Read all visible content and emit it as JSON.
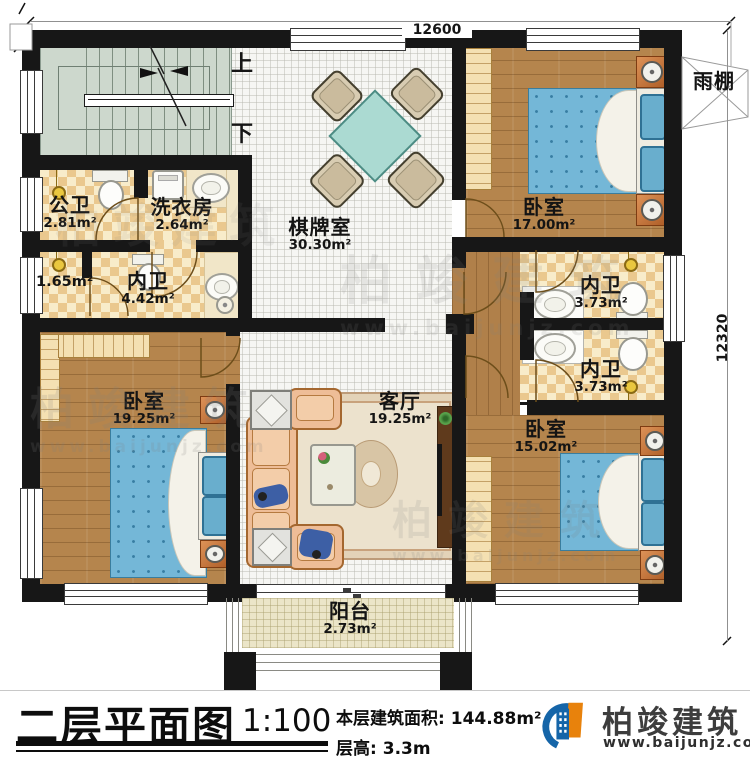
{
  "dimensions": {
    "width_label": "12600",
    "height_label": "12320"
  },
  "stairs": {
    "up": "上",
    "down": "下"
  },
  "rooms": {
    "public_bath": {
      "name": "公卫",
      "area": "2.81m²"
    },
    "laundry": {
      "name": "洗衣房",
      "area": "2.64m²"
    },
    "game_room": {
      "name": "棋牌室",
      "area": "30.30m²"
    },
    "bedroom_top_right": {
      "name": "卧室",
      "area": "17.00m²"
    },
    "canopy": {
      "name": "雨棚"
    },
    "bath_upper": {
      "name": "内卫",
      "area": "3.73m²"
    },
    "bath_lower": {
      "name": "内卫",
      "area": "3.73m²"
    },
    "bedroom_bottom_right": {
      "name": "卧室",
      "area": "15.02m²"
    },
    "closet": {
      "area": "1.65m²"
    },
    "bath_left": {
      "name": "内卫",
      "area": "4.42m²"
    },
    "bedroom_bottom_left": {
      "name": "卧室",
      "area": "19.25m²"
    },
    "living_room": {
      "name": "客厅",
      "area": "19.25m²"
    },
    "balcony": {
      "name": "阳台",
      "area": "2.73m²"
    }
  },
  "footer": {
    "title": "二层平面图",
    "scale": "1:100",
    "area_label": "本层建筑面积:",
    "area_value": "144.88m²",
    "floor_height_label": "层高:",
    "floor_height_value": "3.3m",
    "brand": "柏竣建筑",
    "website": "www.baijunjz.com"
  },
  "watermark": {
    "brand": "柏竣建筑",
    "website": "www.baijunjz.com"
  },
  "colors": {
    "wall": "#171717",
    "wood": "#b5854d",
    "tile": "#f6f6f3",
    "checker": "#eac88e",
    "bed": "#74b7d7",
    "game_table": "#abdad2",
    "sofa": "#eebd97",
    "brand_blue": "#1565a8",
    "brand_orange": "#e8820c"
  }
}
